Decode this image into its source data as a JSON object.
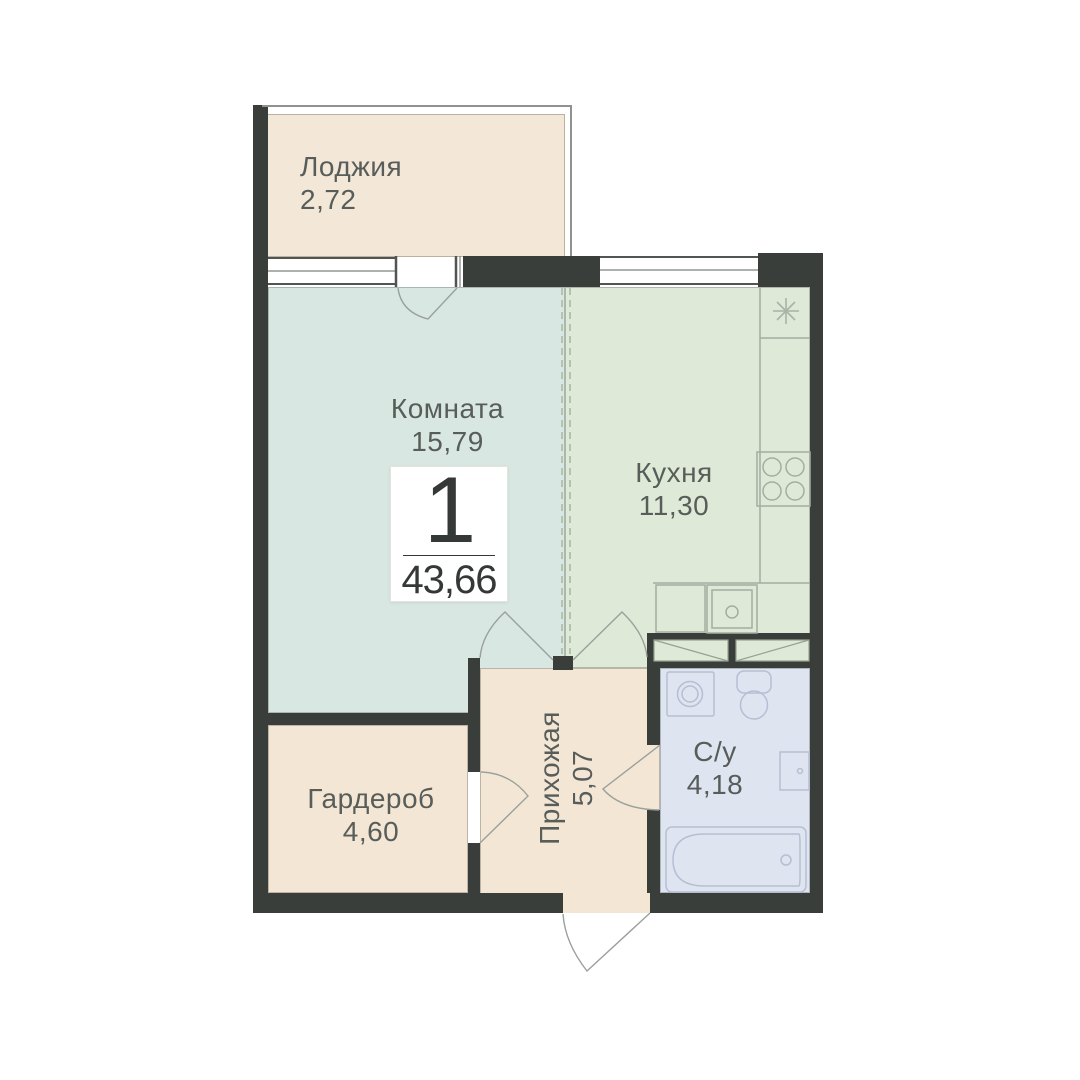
{
  "plan": {
    "badge": {
      "number": "1",
      "total_area": "43,66"
    },
    "rooms": {
      "loggia": {
        "label": "Лоджия",
        "area": "2,72"
      },
      "room": {
        "label": "Комната",
        "area": "15,79"
      },
      "kitchen": {
        "label": "Кухня",
        "area": "11,30"
      },
      "wardrobe": {
        "label": "Гардероб",
        "area": "4,60"
      },
      "hallway": {
        "label": "Прихожая",
        "area": "5,07"
      },
      "bathroom": {
        "label": "С/у",
        "area": "4,18"
      }
    },
    "icons": [
      "window-icon",
      "balcony-door-icon",
      "room-door-icon",
      "kitchen-door-icon",
      "wardrobe-door-icon",
      "bathroom-door-icon",
      "entrance-door-icon",
      "vent-icon",
      "stove-icon",
      "kitchen-sink-icon",
      "counter-icon",
      "cabinet-icon",
      "washing-machine-icon",
      "toilet-icon",
      "bathroom-sink-icon",
      "bathtub-icon"
    ],
    "colors": {
      "wall": "#3a3e3b",
      "room_fill": "#d8e7e1",
      "kitchen_fill": "#dfe9d7",
      "loggia_fill": "#f3e7d8",
      "hallway_fill": "#f3e6d5",
      "wardrobe_fill": "#f3e6d5",
      "bathroom_fill": "#dfe4f1",
      "text": "#585d5a"
    }
  }
}
